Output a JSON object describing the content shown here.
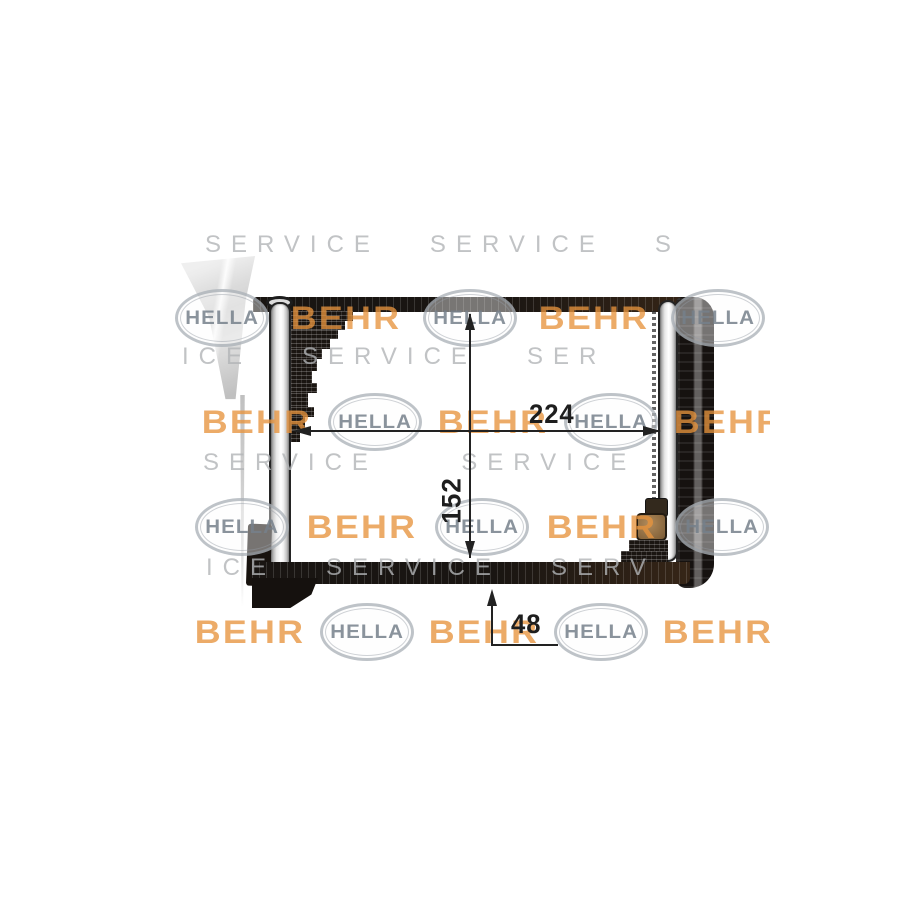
{
  "image": {
    "description": "heater-core product photo with dimension drawing",
    "dimension_labels": {
      "width": "224",
      "height": "152",
      "depth": "48"
    }
  },
  "watermark": {
    "behr_text": "BEHR",
    "hella_text": "HELLA",
    "letter_rows": [
      {
        "left": 205,
        "top": 233,
        "text": "SERVICE   SERVICE   S"
      },
      {
        "left": 182,
        "top": 345,
        "text": "ICE   SERVICE   SER"
      },
      {
        "left": 203,
        "top": 451,
        "text": "SERVICE     SERVICE"
      },
      {
        "left": 206,
        "top": 556,
        "text": "ICE   SERVICE   SERV"
      }
    ],
    "logo_rows": [
      {
        "cy": 318,
        "start": "hella",
        "x0": 222,
        "step": 124
      },
      {
        "cy": 422,
        "start": "behr",
        "x0": 257,
        "step": 118
      },
      {
        "cy": 527,
        "start": "hella",
        "x0": 242,
        "step": 120
      },
      {
        "cy": 632,
        "start": "behr",
        "x0": 250,
        "step": 117
      }
    ],
    "logos_per_row": 5
  }
}
